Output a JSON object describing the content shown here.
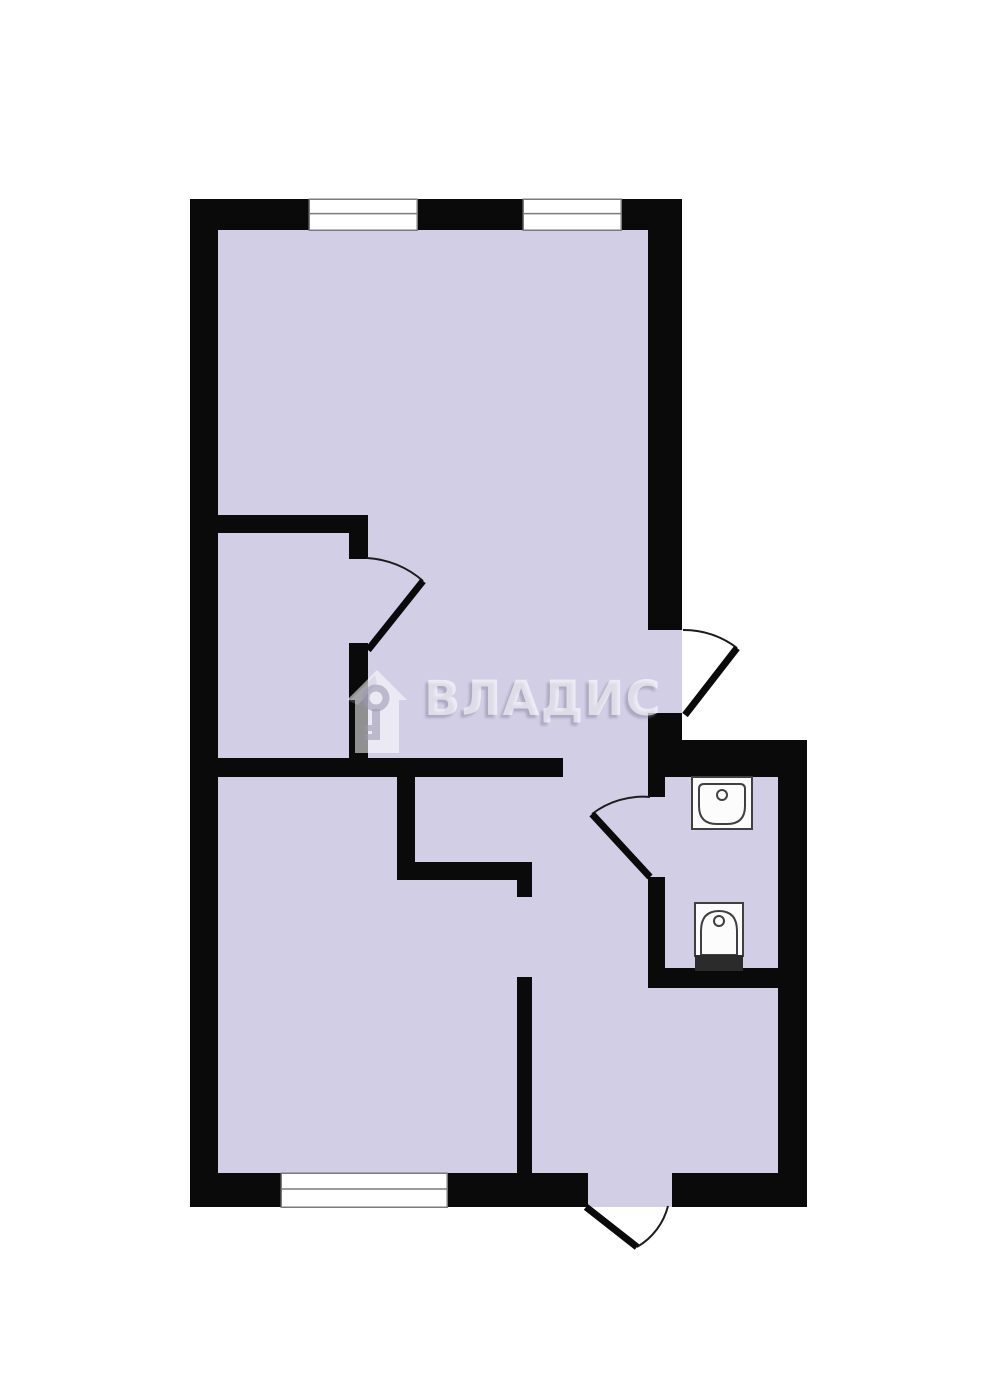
{
  "watermark": {
    "text": "ВЛАДИС"
  },
  "colors": {
    "background": "#ffffff",
    "room_fill": "#d2cee5",
    "wall": "#0a0a0a",
    "window_fill": "#ffffff",
    "window_border": "#7b7b7b",
    "door_arc": "#1c1c1c",
    "fixture_fill": "#fcfcfc",
    "fixture_stroke": "#404040",
    "toilet_tank": "#2b2b2b",
    "watermark_house": "rgba(255,255,255,0.55)",
    "watermark_house_shadow": "rgba(123,120,150,0.38)",
    "watermark_key": "rgba(156,153,180,0.60)",
    "watermark_text": "rgba(255,255,255,0.60)",
    "watermark_text_shadow": "rgba(118,115,145,0.40)"
  },
  "plan": {
    "canvas": {
      "width": 984,
      "height": 1400
    },
    "rooms": [
      {
        "x": 204,
        "y": 213,
        "w": 458,
        "h": 555
      },
      {
        "x": 204,
        "y": 758,
        "w": 458,
        "h": 432
      },
      {
        "x": 648,
        "y": 756,
        "w": 142,
        "h": 434
      },
      {
        "x": 648,
        "y": 630,
        "w": 34,
        "h": 85
      },
      {
        "x": 588,
        "y": 1173,
        "w": 84,
        "h": 34
      }
    ],
    "walls": [
      {
        "x": 190,
        "y": 199,
        "w": 492,
        "h": 31
      },
      {
        "x": 190,
        "y": 199,
        "w": 28,
        "h": 1008
      },
      {
        "x": 190,
        "y": 1173,
        "w": 398,
        "h": 34
      },
      {
        "x": 672,
        "y": 1173,
        "w": 135,
        "h": 34
      },
      {
        "x": 648,
        "y": 199,
        "w": 34,
        "h": 431
      },
      {
        "x": 648,
        "y": 713,
        "w": 34,
        "h": 33
      },
      {
        "x": 648,
        "y": 740,
        "w": 159,
        "h": 37
      },
      {
        "x": 778,
        "y": 740,
        "w": 29,
        "h": 467
      },
      {
        "x": 190,
        "y": 515,
        "w": 178,
        "h": 18
      },
      {
        "x": 349,
        "y": 533,
        "w": 19,
        "h": 26
      },
      {
        "x": 349,
        "y": 643,
        "w": 19,
        "h": 115
      },
      {
        "x": 190,
        "y": 758,
        "w": 373,
        "h": 19
      },
      {
        "x": 397,
        "y": 777,
        "w": 18,
        "h": 103
      },
      {
        "x": 397,
        "y": 862,
        "w": 135,
        "h": 18
      },
      {
        "x": 517,
        "y": 880,
        "w": 15,
        "h": 17
      },
      {
        "x": 517,
        "y": 977,
        "w": 15,
        "h": 200
      },
      {
        "x": 648,
        "y": 713,
        "w": 17,
        "h": 84
      },
      {
        "x": 648,
        "y": 877,
        "w": 17,
        "h": 111
      },
      {
        "x": 648,
        "y": 968,
        "w": 130,
        "h": 20
      }
    ],
    "windows": [
      {
        "x": 309,
        "y": 199,
        "w": 108,
        "h": 31
      },
      {
        "x": 523,
        "y": 199,
        "w": 98,
        "h": 31
      },
      {
        "x": 281,
        "y": 1173,
        "w": 166,
        "h": 34
      }
    ],
    "doors": [
      {
        "leaf": [
          368,
          650,
          423,
          581
        ],
        "arc": {
          "from": [
            367,
            558
          ],
          "to": [
            423,
            581
          ],
          "r": 92,
          "sweep": 1
        }
      },
      {
        "leaf": [
          685,
          715,
          737,
          648
        ],
        "arc": {
          "from": [
            683,
            630
          ],
          "to": [
            737,
            648
          ],
          "r": 87,
          "sweep": 1
        }
      },
      {
        "leaf": [
          650,
          877,
          592,
          814
        ],
        "arc": {
          "from": [
            650,
            797
          ],
          "to": [
            592,
            814
          ],
          "r": 83,
          "sweep": 0
        }
      },
      {
        "leaf": [
          586,
          1207,
          637,
          1247
        ],
        "arc": {
          "from": [
            668,
            1206
          ],
          "to": [
            637,
            1247
          ],
          "r": 66,
          "sweep": 1
        }
      }
    ],
    "fixtures": {
      "sink": {
        "box": {
          "x": 692,
          "y": 777,
          "w": 60,
          "h": 52
        },
        "basin_path": "M699 789 Q699 784 704 784 L740 784 Q745 784 745 789 L745 806 Q745 824 727 824 L717 824 Q699 824 699 806 Z",
        "knob": {
          "cx": 722,
          "cy": 795,
          "r": 5
        }
      },
      "toilet": {
        "box": {
          "x": 695,
          "y": 903,
          "w": 48,
          "h": 53
        },
        "bowl_path": "M701 955 L701 931 Q701 911 719 911 Q737 911 737 931 L737 955 Z",
        "knob": {
          "cx": 719,
          "cy": 921,
          "r": 5
        },
        "tank": {
          "x": 695,
          "y": 955,
          "w": 48,
          "h": 16
        }
      }
    }
  }
}
